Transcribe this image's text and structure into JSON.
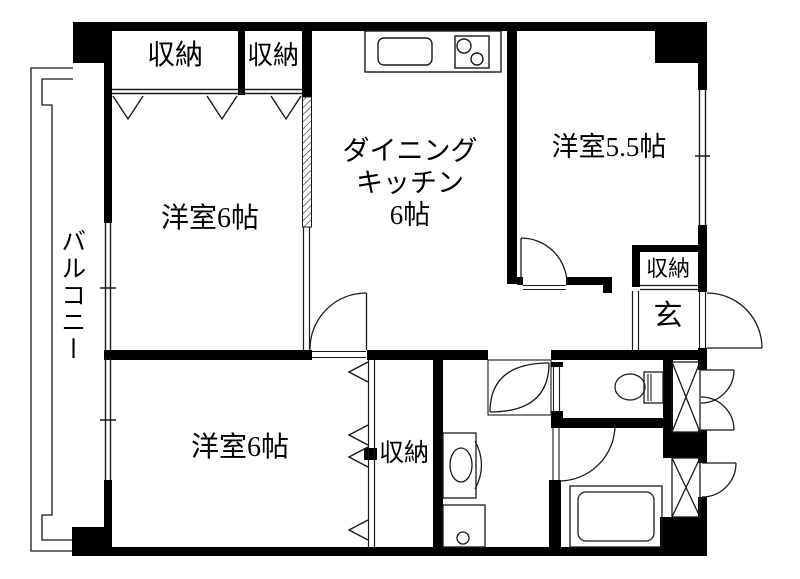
{
  "floorplan": {
    "balcony": {
      "label": "バルコニー"
    },
    "closet_top_left": {
      "label": "収納"
    },
    "closet_top_right": {
      "label": "収納"
    },
    "bedroom_upper_left": {
      "label": "洋室6帖"
    },
    "dining_kitchen": {
      "line1": "ダイニング",
      "line2": "キッチン",
      "line3": "6帖"
    },
    "bedroom_right": {
      "label": "洋室5.5帖"
    },
    "closet_entrance": {
      "label": "収納"
    },
    "entrance": {
      "label": "玄"
    },
    "bedroom_lower_left": {
      "label": "洋室6帖"
    },
    "closet_lower": {
      "label": "収納"
    },
    "colors": {
      "wall": "#000000",
      "line": "#1a1a1a",
      "background": "#ffffff"
    }
  }
}
